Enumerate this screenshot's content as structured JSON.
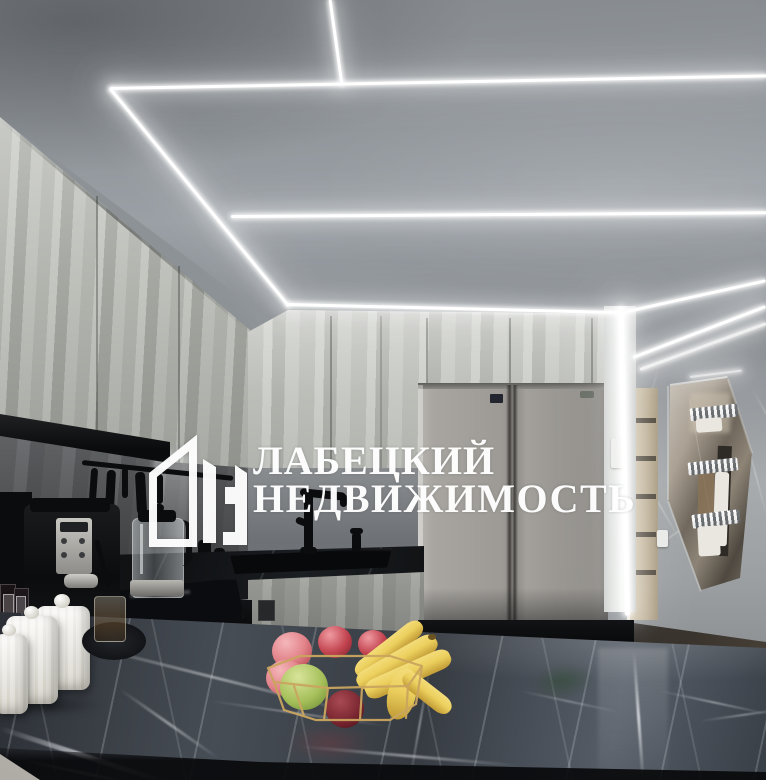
{
  "watermark": {
    "logo_icon": "house-buildings-icon",
    "line1": "ЛАБЕЦКИЙ",
    "line2": "НЕДВИЖИМОСТЬ",
    "color": "#ffffff"
  },
  "scene": {
    "setting": "kitchen-interior-photo",
    "objects": [
      "led-ceiling-strips",
      "concrete-texture-cabinets",
      "side-by-side-refrigerator",
      "black-marble-countertop",
      "double-sink",
      "black-faucet",
      "espresso-machine",
      "glass-kettle",
      "spice-jars",
      "white-ceramic-canisters",
      "induction-cooktop",
      "marble-island",
      "gold-wire-fruit-basket",
      "red-apples",
      "green-apple",
      "bananas",
      "interior-door",
      "faceted-mirror-panel",
      "chrome-towel-hooks",
      "light-switch",
      "hallway-floor"
    ]
  },
  "palette": {
    "led": "#ffffff",
    "watermark": "#ffffff",
    "appleRed": "#c24450",
    "applePink": "#e2838a",
    "appleDark": "#77242f",
    "appleGreen": "#a6c05b",
    "banana": "#ecd05e",
    "bananaSh": "#c29b36",
    "gold": "#caa55f"
  }
}
